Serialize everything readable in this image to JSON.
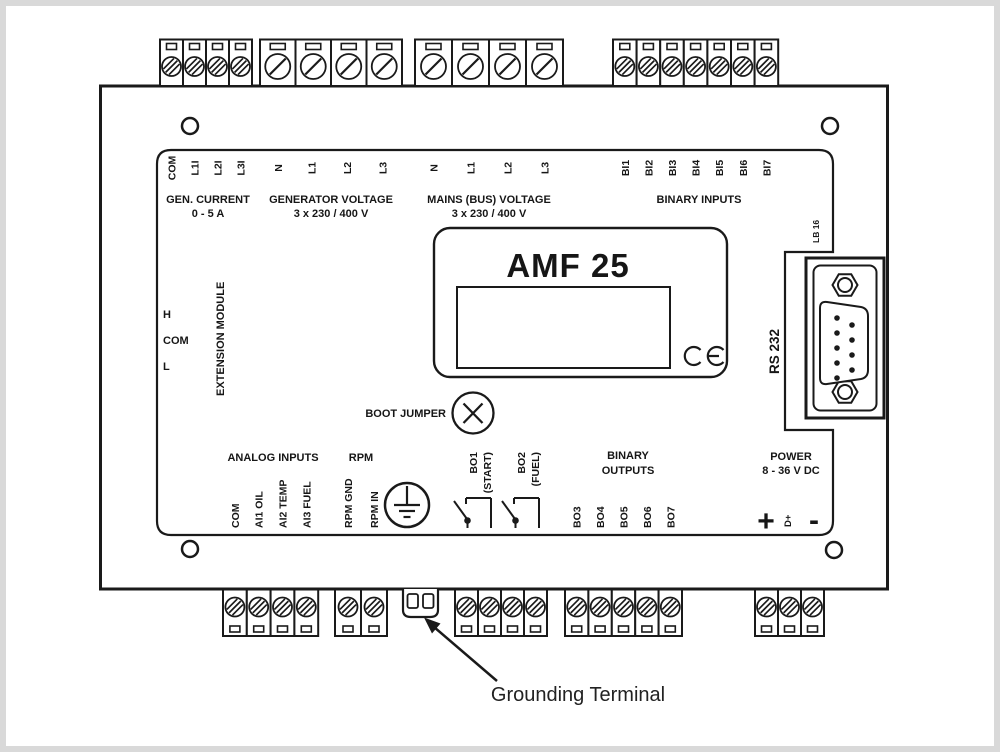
{
  "sections": {
    "gen_current": {
      "title": "GEN. CURRENT",
      "subtitle": "0 - 5 A",
      "terminals": [
        "COM",
        "L1I",
        "L2I",
        "L3I"
      ]
    },
    "generator_voltage": {
      "title": "GENERATOR VOLTAGE",
      "subtitle": "3 x 230 / 400 V",
      "terminals": [
        "N",
        "L1",
        "L2",
        "L3"
      ]
    },
    "mains_voltage": {
      "title": "MAINS (BUS) VOLTAGE",
      "subtitle": "3 x 230 / 400 V",
      "terminals": [
        "N",
        "L1",
        "L2",
        "L3"
      ]
    },
    "binary_inputs": {
      "title": "BINARY INPUTS",
      "terminals": [
        "BI1",
        "BI2",
        "BI3",
        "BI4",
        "BI5",
        "BI6",
        "BI7"
      ]
    },
    "extension_module": {
      "title": "EXTENSION MODULE",
      "terminals": [
        "H",
        "COM",
        "L"
      ]
    },
    "rs232": {
      "title": "RS 232",
      "board_label": "LB 16"
    },
    "boot_jumper": {
      "title": "BOOT JUMPER"
    },
    "analog_inputs": {
      "title": "ANALOG INPUTS",
      "terminals": [
        "COM",
        "AI1 OIL",
        "AI2 TEMP",
        "AI3 FUEL"
      ]
    },
    "rpm": {
      "title": "RPM",
      "terminals": [
        "RPM GND",
        "RPM IN"
      ]
    },
    "binary_outputs": {
      "title_line1": "BINARY",
      "title_line2": "OUTPUTS",
      "bo1_label": "BO1",
      "bo1_function": "(START)",
      "bo2_label": "BO2",
      "bo2_function": "(FUEL)",
      "terminals": [
        "BO3",
        "BO4",
        "BO5",
        "BO6",
        "BO7"
      ]
    },
    "power": {
      "title": "POWER",
      "subtitle": "8 - 36 V DC",
      "terminals": [
        "+",
        "D+",
        "-"
      ]
    }
  },
  "device": {
    "model": "AMF 25",
    "ce_mark": "CE"
  },
  "annotation": {
    "grounding_terminal": "Grounding Terminal"
  },
  "colors": {
    "line": "#1a1a1a",
    "background": "#ffffff",
    "frame_border": "#d9d9d9"
  }
}
